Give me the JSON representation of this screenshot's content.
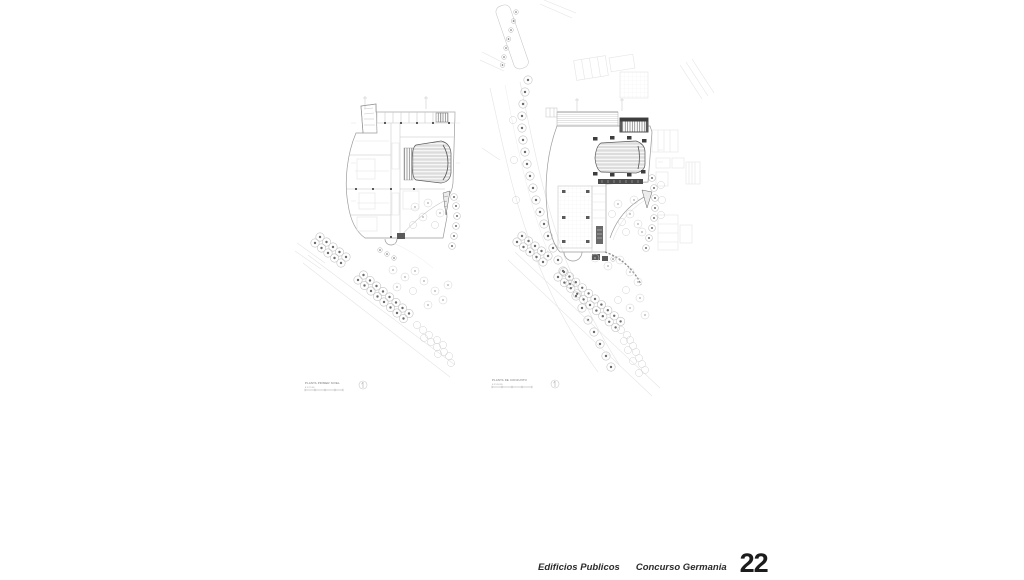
{
  "sheet": {
    "background": "#ffffff"
  },
  "footer": {
    "project": "Edificios Publicos",
    "competition": "Concurso Germania",
    "page_number": "22",
    "text_color": "#2b2b2b"
  },
  "plans": {
    "left": {
      "caption": "PLANTA PRIMER NIVEL",
      "scale_text": "0  1  2  5  10"
    },
    "right": {
      "caption": "PLANTA DE CONJUNTO",
      "scale_text": "0  2  5  10  20"
    }
  },
  "drawing_colors": {
    "line_faint": "#e4e4e4",
    "line_light": "#c6c6c6",
    "line_mid": "#9b9b9b",
    "line_dark": "#555555",
    "ink": "#3d3d3d",
    "tree_dot": "#6a6a6a",
    "paper": "#ffffff"
  }
}
